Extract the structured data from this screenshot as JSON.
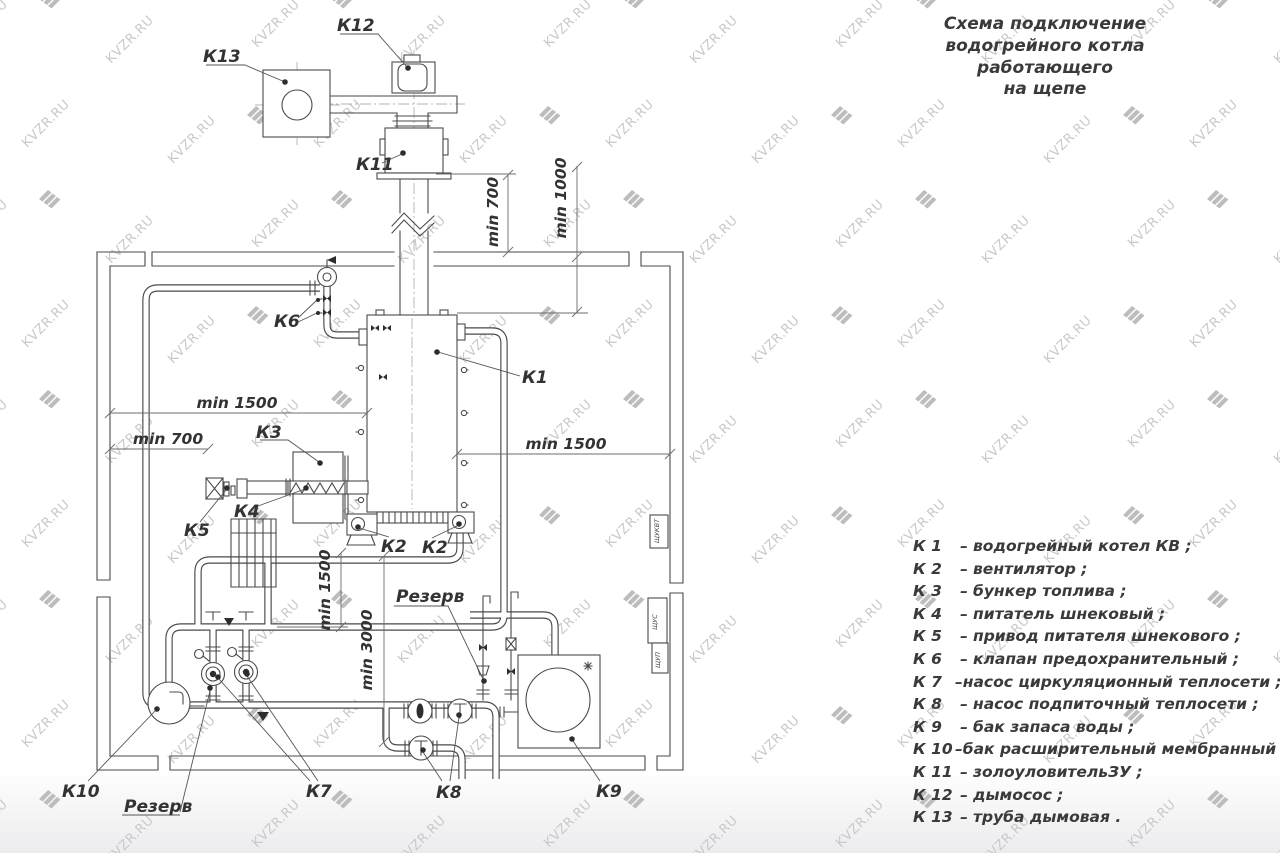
{
  "title": {
    "line1": "Схема подключение",
    "line2": "водогрейного котла работающего",
    "line3": "на щепе"
  },
  "watermark": {
    "text": "KVZR.RU"
  },
  "legend": {
    "dash": "–",
    "items": [
      {
        "k": "К 1",
        "text": "водогрейный котел КВ ;"
      },
      {
        "k": "К 2",
        "text": "вентилятор ;"
      },
      {
        "k": "К 3",
        "text": "бункер топлива ;"
      },
      {
        "k": "К 4",
        "text": "питатель шнековый ;"
      },
      {
        "k": "К 5",
        "text": "привод питателя шнекового ;"
      },
      {
        "k": "К 6",
        "text": "клапан предохранительный ;"
      },
      {
        "k": "К 7",
        "text": "насос циркуляционный теплосети ;"
      },
      {
        "k": "К 8",
        "text": "насос подпиточный теплосети ;"
      },
      {
        "k": "К 9",
        "text": "бак запаса воды ;"
      },
      {
        "k": "К 10",
        "text": "бак расширительный мембранный ;"
      },
      {
        "k": "К 11",
        "text": "золоуловительЗУ ;"
      },
      {
        "k": "К 12",
        "text": "дымосос ;"
      },
      {
        "k": "К 13",
        "text": "труба дымовая ."
      }
    ]
  },
  "diagram": {
    "labels": {
      "k1": "К1",
      "k2a": "К2",
      "k2b": "К2",
      "k3": "К3",
      "k4": "К4",
      "k5": "К5",
      "k6": "К6",
      "k7": "К7",
      "k8": "К8",
      "k9": "К9",
      "k10": "К10",
      "k11": "К11",
      "k12": "К12",
      "k13": "К13",
      "reserve_top": "Резерв",
      "reserve_bottom": "Резерв"
    },
    "dimensions": {
      "min700_top": "min 700",
      "min1000": "min 1000",
      "min1500_left": "min 1500",
      "min700_left": "min 700",
      "min1500_right": "min 1500",
      "min1500_vert": "min 1500",
      "min3000": "min 3000"
    },
    "panels": {
      "p1": "ЩУКВТ",
      "p2": "ЩУС",
      "p3": "ЩУП"
    }
  }
}
